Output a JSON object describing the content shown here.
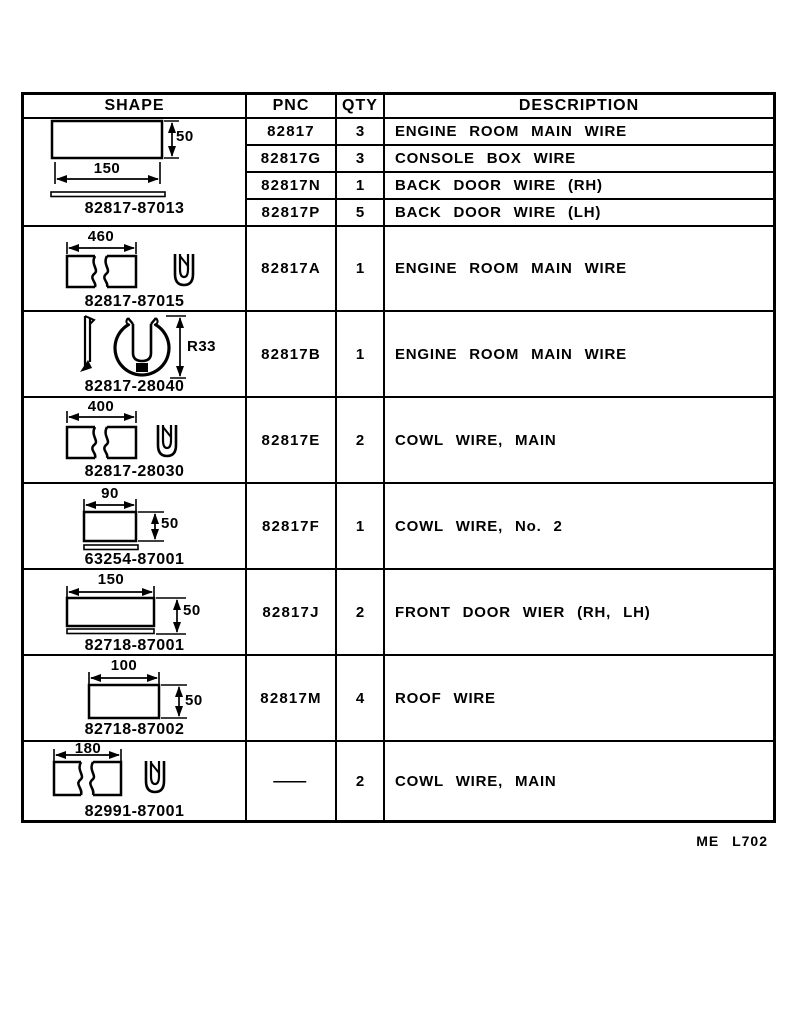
{
  "table": {
    "header": {
      "shape": "SHAPE",
      "pnc": "PNC",
      "qty": "QTY",
      "description": "DESCRIPTION"
    },
    "groups": [
      {
        "part_label": "82817-87013",
        "dims": {
          "width": "150",
          "height": "50"
        },
        "rows": [
          {
            "pnc": "82817",
            "qty": "3",
            "description": "ENGINE ROOM MAIN WIRE"
          },
          {
            "pnc": "82817G",
            "qty": "3",
            "description": "CONSOLE BOX WIRE"
          },
          {
            "pnc": "82817N",
            "qty": "1",
            "description": "BACK DOOR WIRE (RH)"
          },
          {
            "pnc": "82817P",
            "qty": "5",
            "description": "BACK DOOR WIRE (LH)"
          }
        ]
      },
      {
        "part_label": "82817-87015",
        "dims": {
          "length": "460"
        },
        "pnc": "82817A",
        "qty": "1",
        "description": "ENGINE ROOM MAIN WIRE"
      },
      {
        "part_label": "82817-28040",
        "dims": {
          "radius": "R33"
        },
        "pnc": "82817B",
        "qty": "1",
        "description": "ENGINE ROOM MAIN WIRE"
      },
      {
        "part_label": "82817-28030",
        "dims": {
          "length": "400"
        },
        "pnc": "82817E",
        "qty": "2",
        "description": "COWL WIRE, MAIN"
      },
      {
        "part_label": "63254-87001",
        "dims": {
          "width": "90",
          "height": "50"
        },
        "pnc": "82817F",
        "qty": "1",
        "description": "COWL WIRE, No. 2"
      },
      {
        "part_label": "82718-87001",
        "dims": {
          "width": "150",
          "height": "50"
        },
        "pnc": "82817J",
        "qty": "2",
        "description": "FRONT DOOR WIER (RH, LH)"
      },
      {
        "part_label": "82718-87002",
        "dims": {
          "width": "100",
          "height": "50"
        },
        "pnc": "82817M",
        "qty": "4",
        "description": "ROOF WIRE"
      },
      {
        "part_label": "82991-87001",
        "dims": {
          "length": "180"
        },
        "pnc": "—",
        "qty": "2",
        "description": "COWL WIRE, MAIN"
      }
    ]
  },
  "footer": {
    "code": "ME L702"
  },
  "colors": {
    "ink": "#000000",
    "paper": "#ffffff"
  }
}
